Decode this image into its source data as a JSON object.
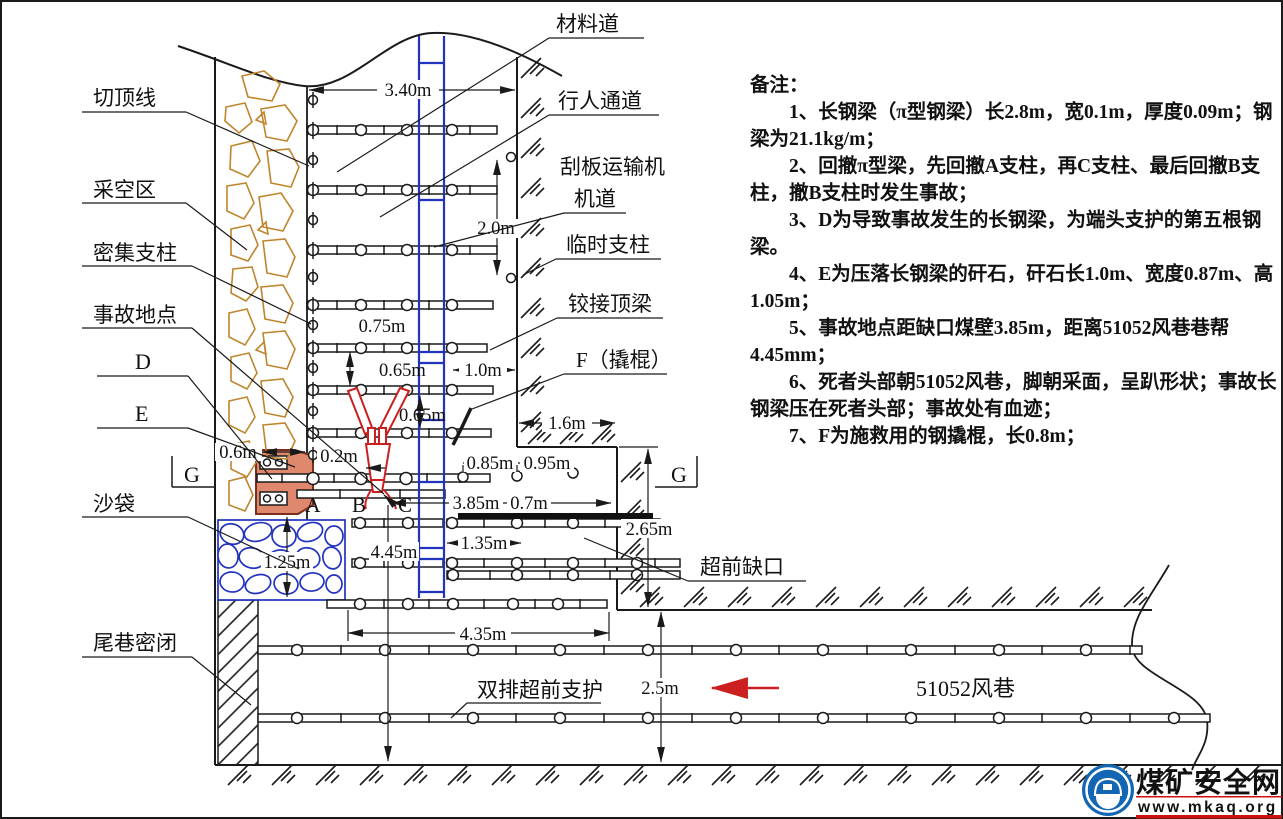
{
  "drawing": {
    "labels": {
      "cut_top_line": "切顶线",
      "gob_area": "采空区",
      "dense_props": "密集支柱",
      "accident_site": "事故地点",
      "d": "D",
      "e": "E",
      "g_left": "G",
      "g_right": "G",
      "sandbags": "沙袋",
      "tail_seal": "尾巷密闭",
      "material_road": "材料道",
      "walkway": "行人通道",
      "scraper_conveyor": "刮板运输机",
      "machine_lane": "机道",
      "temp_prop": "临时支柱",
      "hinged_beam": "铰接顶梁",
      "f_crowbar": "F（撬棍）",
      "advance_notch": "超前缺口",
      "double_row_support": "双排超前支护",
      "airway": "51052风巷",
      "a": "A",
      "b": "B",
      "c": "C"
    },
    "dimensions": {
      "top_width": "3.40m",
      "wall_height": "2.0m",
      "prop_span": "0.75m",
      "row_gap1": "0.65m",
      "row_gap2": "0.65m",
      "beam_to_wall": "1.0m",
      "notch_top": "1.6m",
      "rock_width": "0.6m",
      "offset_b": "0.2m",
      "prop_a": "0.85m",
      "prop_b": "0.95m",
      "to_notch_wall": "3.85m",
      "extra": "0.7m",
      "beam_overlap": "1.35m",
      "to_airway": "4.45m",
      "notch_depth": "2.65m",
      "bottom_span": "4.35m",
      "sandbag_height": "1.25m",
      "airway_width": "2.5m"
    },
    "notes": {
      "title": "备注：",
      "items": [
        "1、长钢梁（π型钢梁）长2.8m，宽0.1m，厚度0.09m；钢梁为21.1kg/m；",
        "2、回撤π型梁，先回撤A支柱，再C支柱、最后回撤B支柱，撤B支柱时发生事故；",
        "3、D为导致事故发生的长钢梁，为端头支护的第五根钢梁。",
        "4、E为压落长钢梁的矸石，矸石长1.0m、宽度0.87m、高1.05m；",
        "5、事故地点距缺口煤壁3.85m，距离51052风巷巷帮4.45mm；",
        "6、死者头部朝51052风巷，脚朝采面，呈趴形状；事故长钢梁压在死者头部；事故处有血迹；",
        "7、F为施救用的钢撬棍，长0.8m；"
      ]
    },
    "watermark": {
      "site_name": "煤矿安全网",
      "site_url": "www.mkaq.org"
    },
    "colors": {
      "line": "#1a1a1a",
      "gob": "#bf852d",
      "blue": "#2233c0",
      "red": "#cc2020",
      "rock_fill": "#e0886e",
      "logo_blue": "#1266b3",
      "logo_red": "#cc1111"
    }
  }
}
